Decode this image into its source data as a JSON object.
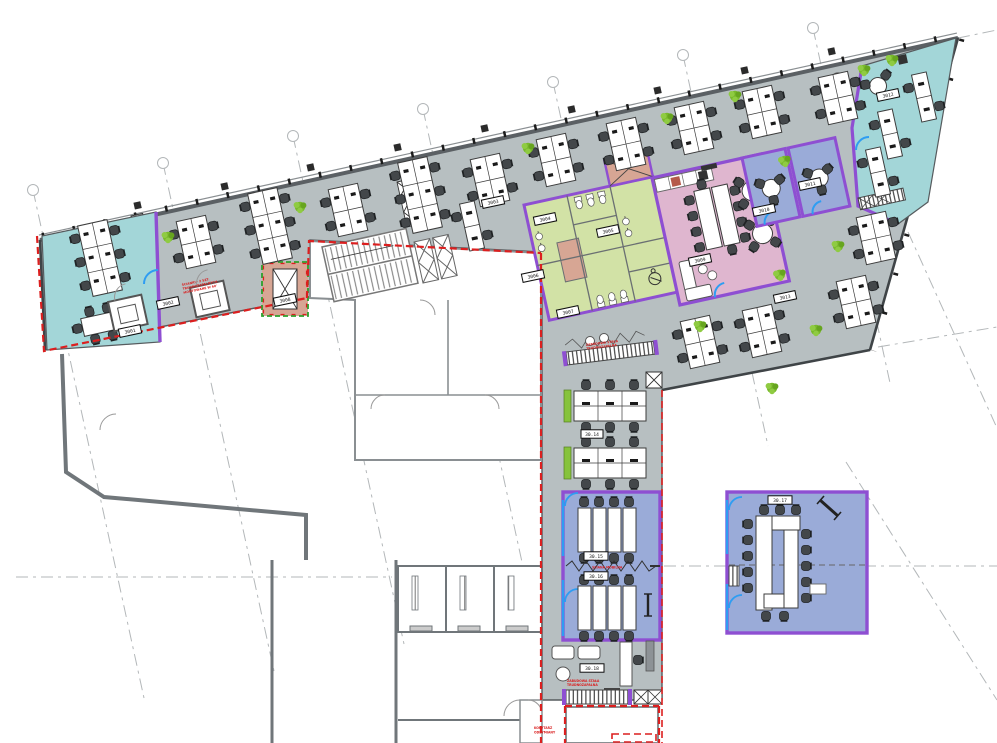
{
  "drawing_title": "office-floor-plan",
  "colors": {
    "floor": "#b7bfc1",
    "zone_cyan": "#a3d6d8",
    "zone_green": "#d2e2a6",
    "zone_pink": "#dfb6cf",
    "zone_salmon": "#d7a694",
    "zone_blue": "#9aabd8",
    "wall_purple": "#8e4fd2",
    "door_blue": "#2e9df2",
    "lease_red": "#dc1f1f",
    "plant_green": "#79b92c"
  },
  "annotations": {
    "partition_note_l1": "ŚCIANKI - 2 SZT.",
    "partition_note_l2": "TRUDNOZAPALNYCH,",
    "partition_note_l3": "MONTOWANE W 60'",
    "cabinet_mid_l1": "ZABUDOWA STAŁA",
    "cabinet_mid_l2": "TRUDNOZAPALNA",
    "mobile_wall": "ŚCIANA MOBILNA",
    "cabinet_bottom_l1": "ZABUDOWA STAŁA",
    "cabinet_bottom_l2": "TRUDNOZAPALNA",
    "smoke_corridor_l1": "KORYTARZ",
    "smoke_corridor_l2": "ODDYMIANY"
  },
  "tags": {
    "cyan_left": "3001",
    "lobby": "3002",
    "open_office": "3003",
    "wc_1": "3004",
    "wc_2": "3005",
    "wc_3": "3006",
    "wc_4": "3007",
    "shaft": "3008",
    "canteen": "3009",
    "meet_a": "3010",
    "meet_b": "3011",
    "cyan_right": "3012",
    "open_east": "3013",
    "bench_zone": "30.14",
    "conf_a": "30.15",
    "conf_b": "30.16",
    "conf_c": "30.17",
    "lounge": "30.18"
  }
}
